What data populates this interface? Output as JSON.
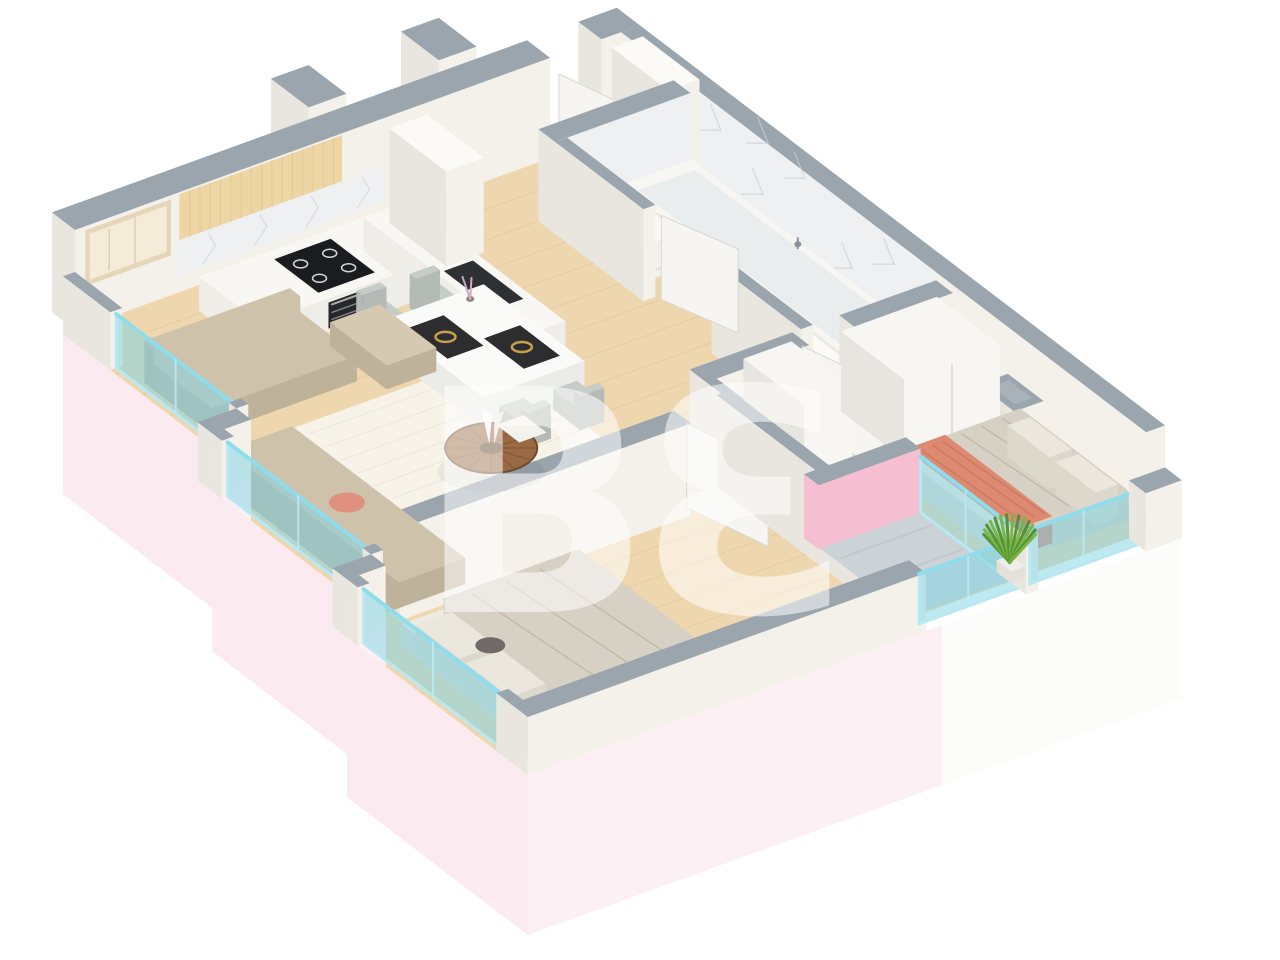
{
  "watermark": {
    "text": "BƐ"
  },
  "scene": {
    "type": "isometric-3d-floor-plan",
    "rooms": [
      "living-room-kitchen",
      "entry-hall",
      "bathroom",
      "bedroom-1",
      "bedroom-2",
      "balcony"
    ],
    "objects": [
      "l-shaped-sofa",
      "pouf",
      "round-coffee-table",
      "rug",
      "picture-frame",
      "kitchen-cabinets",
      "cooktop",
      "oven",
      "sink",
      "dining-table",
      "dining-chairs",
      "fridge-column",
      "entry-door",
      "bathtub",
      "vanity",
      "washer",
      "bed-single",
      "bed-double",
      "coral-throw",
      "wardrobes",
      "balcony-glass-railing",
      "plant",
      "panoramic-windows"
    ]
  },
  "colors": {
    "bg": "#ffffff",
    "cap": "#9aa5ae",
    "wallIn": "#f4f1ea",
    "wallSide": "#e9e6df",
    "wallWhite": "#fbfaf7",
    "marble": "#eef0f1",
    "marbleVein": "#c9d0d6",
    "basePink": "#fdf0f4",
    "basePinkSide": "#fbeaf0",
    "baseWhite": "#fcfcfb",
    "floorWood": "#eed7ae",
    "floorLine": "#d9ba8a",
    "rug": "#f7f5ee",
    "balconyFloor": "#ccd3d6",
    "glass": "#7ed3e6",
    "glassFrame": "#b8e9f2",
    "glassRail": "#8fdcec",
    "pink": "#f6bfd1",
    "sofa": "#cfc2ab",
    "sofaSide": "#bfb29a",
    "cushionPink": "#e0907f",
    "pouf": "#d6c9b2",
    "tableWood": "#9a6a44",
    "tableWoodDark": "#6f4a2e",
    "woodCab": "#edd6a4",
    "woodCabLine": "#d9bd85",
    "counterTop": "#f8f7f3",
    "counterSide": "#efede7",
    "cooktop": "#1b1c1f",
    "burner": "#d7dadc",
    "oven": "#26272b",
    "ovenRack": "#8a8c90",
    "sink": "#2e3134",
    "diningTable": "#fafaf8",
    "diningTableSide": "#ebebe7",
    "chair": "#c6ccc7",
    "chairSide": "#b4bab5",
    "placemat": "#2d2d30",
    "gold": "#c6a14b",
    "tub": "#f7f6f3",
    "tubInner": "#e9edee",
    "doorLeaf": "#f6f5f1",
    "doorEdge": "#d8d8d2",
    "bedSheet": "#f0ebe2",
    "bedSide": "#e0dad0",
    "duvet": "#d7d0c4",
    "duvetFold": "#b3a996",
    "coral": "#de8a73",
    "coralFold": "#c37058",
    "pillow": "#ece7dd",
    "wardrobe": "#f7f6f2",
    "wardrobeSide": "#e7e5df",
    "plant1": "#79b43f",
    "plant2": "#4f8f2f",
    "pot": "#f1efe9",
    "frame": "#e6d6b8",
    "frameArt": "#f4ecd9",
    "blob": "#6e6b66",
    "metal": "#8b9196"
  }
}
